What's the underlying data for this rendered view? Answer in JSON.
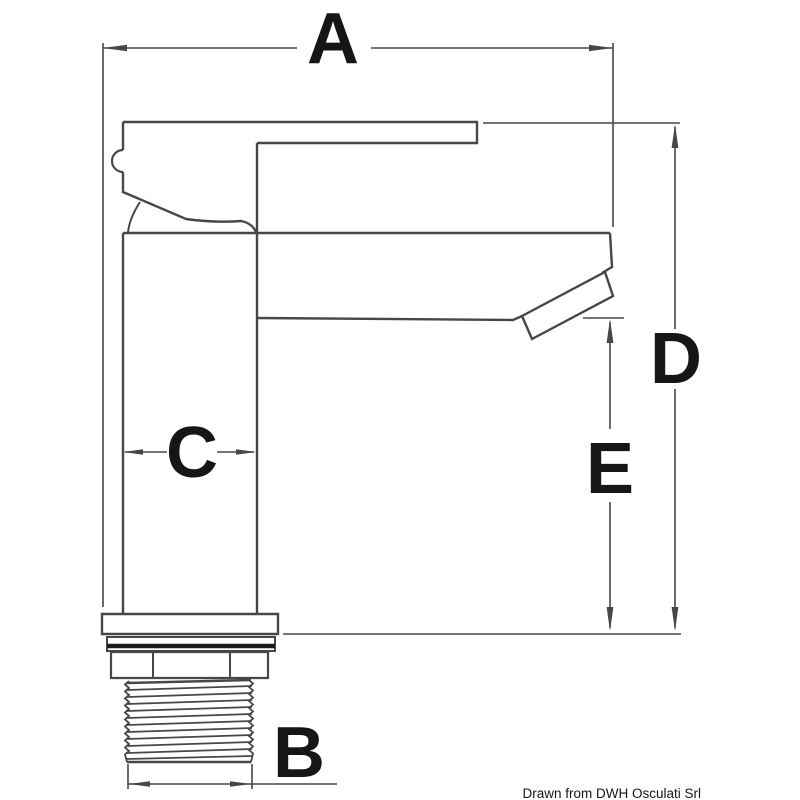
{
  "drawing": {
    "background": "#ffffff",
    "line_color": "#474747",
    "label_color": "#161616",
    "accent_dark": "#1c1c1c",
    "type": "technical dimension drawing",
    "subject": "single-lever basin mixer tap, side elevation"
  },
  "labels": {
    "a": "A",
    "b": "B",
    "c": "C",
    "d": "D",
    "e": "E"
  },
  "credit": "Drawn from DWH Osculati Srl"
}
